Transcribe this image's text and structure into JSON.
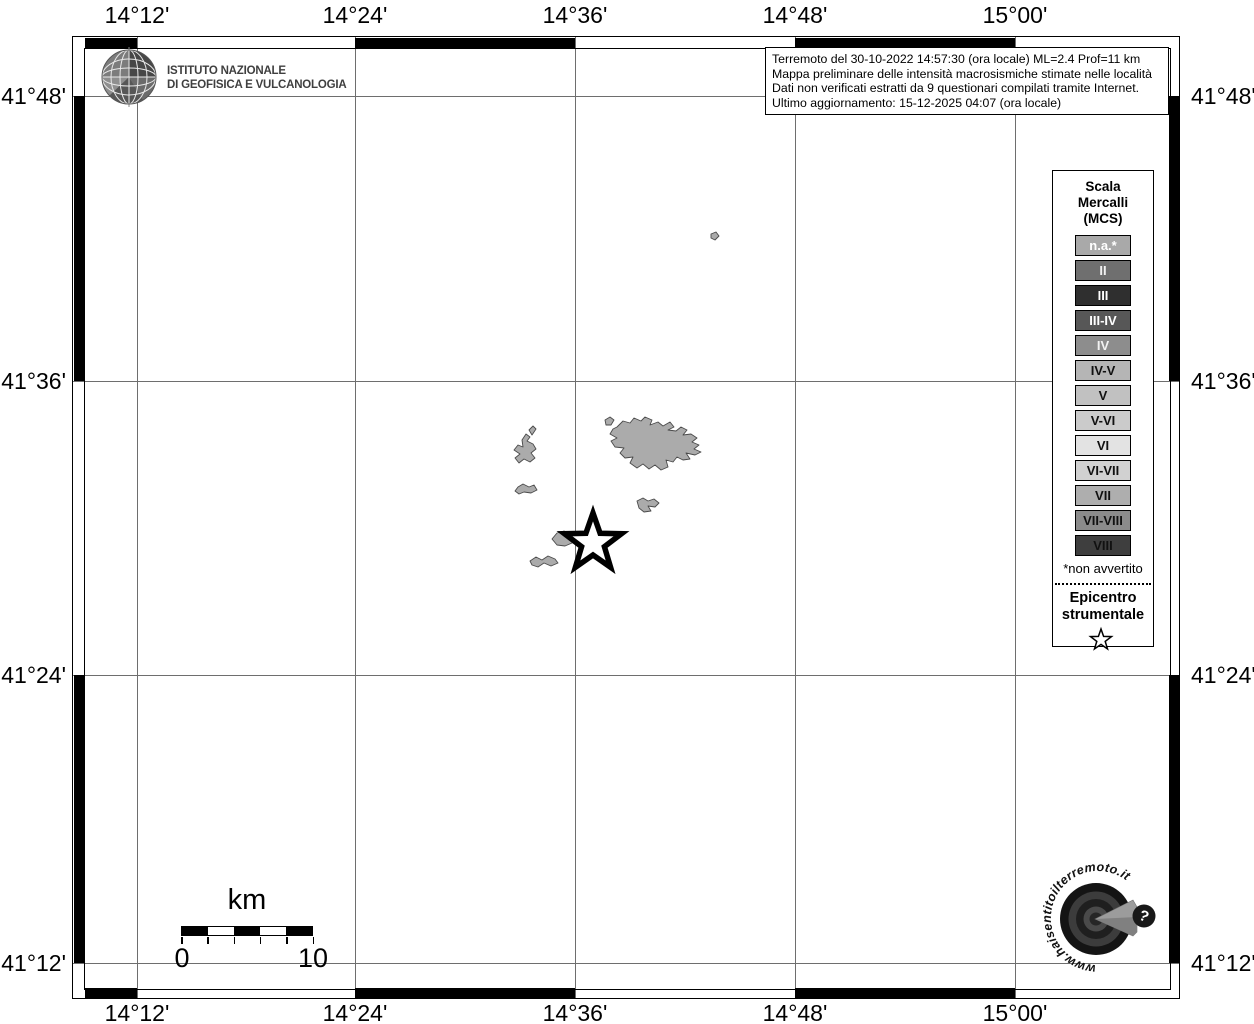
{
  "title_box": {
    "line1": "Terremoto del 30-10-2022 14:57:30 (ora locale) ML=2.4 Prof=11 km",
    "line2": "Mappa preliminare delle intensità macrosismiche stimate nelle località",
    "line3": "Dati non verificati estratti da 9 questionari compilati tramite Internet.",
    "line4": "Ultimo aggiornamento: 15-12-2025 04:07 (ora locale)"
  },
  "ingv_logo": {
    "line1": "ISTITUTO NAZIONALE",
    "line2": "DI GEOFISICA E VULCANOLOGIA"
  },
  "axes": {
    "top": [
      "14°12'",
      "14°24'",
      "14°36'",
      "14°48'",
      "15°00'"
    ],
    "bottom": [
      "14°12'",
      "14°24'",
      "14°36'",
      "14°48'",
      "15°00'"
    ],
    "left": [
      "41°48'",
      "41°36'",
      "41°24'",
      "41°12'"
    ],
    "right": [
      "41°48'",
      "41°36'",
      "41°24'",
      "41°12'"
    ]
  },
  "legend": {
    "title1": "Scala",
    "title2": "Mercalli",
    "title3": "(MCS)",
    "items": [
      {
        "label": "n.a.*",
        "bg": "#a9a9a9",
        "fg": "#ffffff"
      },
      {
        "label": "II",
        "bg": "#6f6f6f",
        "fg": "#f2f2f2"
      },
      {
        "label": "III",
        "bg": "#2f2f2f",
        "fg": "#ffffff"
      },
      {
        "label": "III-IV",
        "bg": "#575757",
        "fg": "#ffffff"
      },
      {
        "label": "IV",
        "bg": "#8d8d8d",
        "fg": "#f2f2f2"
      },
      {
        "label": "IV-V",
        "bg": "#b5b5b5",
        "fg": "#111111"
      },
      {
        "label": "V",
        "bg": "#c1c1c1",
        "fg": "#111111"
      },
      {
        "label": "V-VI",
        "bg": "#cbcbcb",
        "fg": "#111111"
      },
      {
        "label": "VI",
        "bg": "#e3e3e3",
        "fg": "#111111"
      },
      {
        "label": "VI-VII",
        "bg": "#d1d1d1",
        "fg": "#111111"
      },
      {
        "label": "VII",
        "bg": "#aeaeae",
        "fg": "#111111"
      },
      {
        "label": "VII-VIII",
        "bg": "#8b8b8b",
        "fg": "#111111"
      },
      {
        "label": "VIII",
        "bg": "#3e3e3e",
        "fg": "#111111"
      }
    ],
    "footnote": "*non avvertito",
    "epicenter_line1": "Epicentro",
    "epicenter_line2": "strumentale"
  },
  "scale_bar": {
    "unit": "km",
    "min": "0",
    "max": "10"
  },
  "watermark": {
    "url_text": "www.haisentitoilterremoto.it",
    "badge": "?"
  }
}
